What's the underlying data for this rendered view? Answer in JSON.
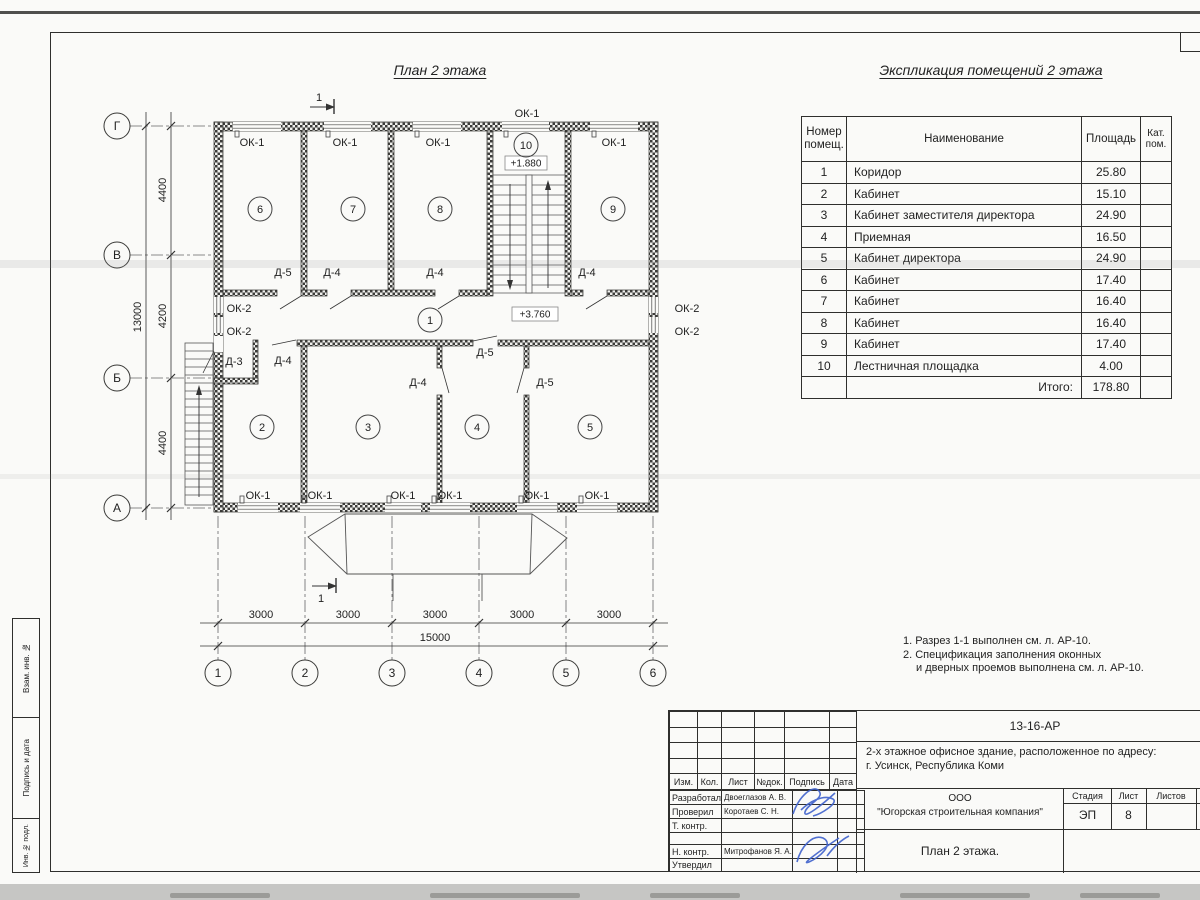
{
  "sheet": {
    "plan_title": "План 2 этажа",
    "expl_title": "Экспликация помещений 2 этажа",
    "notes": [
      "1. Разрез 1-1 выполнен см. л. АР-10.",
      "2. Спецификация заполнения оконных",
      "и дверных проемов выполнена см. л. АР-10."
    ]
  },
  "plan": {
    "axes_v": [
      "Г",
      "В",
      "Б",
      "А"
    ],
    "axes_h": [
      "1",
      "2",
      "3",
      "4",
      "5",
      "6"
    ],
    "dim_v": [
      "4400",
      "4200",
      "4400"
    ],
    "dim_v_total": "13000",
    "dim_h": [
      "3000",
      "3000",
      "3000",
      "3000",
      "3000"
    ],
    "dim_h_total": "15000",
    "rooms": [
      "1",
      "2",
      "3",
      "4",
      "5",
      "6",
      "7",
      "8",
      "9",
      "10"
    ],
    "level_stair": "+1.880",
    "level_corridor": "+3.760",
    "ok1": "ОК-1",
    "ok2": "ОК-2",
    "d3": "Д-3",
    "d4": "Д-4",
    "d5": "Д-5",
    "section": "1"
  },
  "expl": {
    "header": {
      "num1": "Номер",
      "num2": "помещ.",
      "name": "Наименование",
      "area": "Площадь",
      "cat1": "Кат.",
      "cat2": "пом."
    },
    "rows": [
      {
        "n": "1",
        "name": "Коридор",
        "area": "25.80"
      },
      {
        "n": "2",
        "name": "Кабинет",
        "area": "15.10"
      },
      {
        "n": "3",
        "name": "Кабинет заместителя директора",
        "area": "24.90"
      },
      {
        "n": "4",
        "name": "Приемная",
        "area": "16.50"
      },
      {
        "n": "5",
        "name": "Кабинет директора",
        "area": "24.90"
      },
      {
        "n": "6",
        "name": "Кабинет",
        "area": "17.40"
      },
      {
        "n": "7",
        "name": "Кабинет",
        "area": "16.40"
      },
      {
        "n": "8",
        "name": "Кабинет",
        "area": "16.40"
      },
      {
        "n": "9",
        "name": "Кабинет",
        "area": "17.40"
      },
      {
        "n": "10",
        "name": "Лестничная площадка",
        "area": "4.00"
      }
    ],
    "total_label": "Итого:",
    "total": "178.80"
  },
  "stamp": {
    "doc": "13-16-АР",
    "desc1": "2-х этажное офисное здание, расположенное по адресу:",
    "desc2": "г. Усинск, Республика Коми",
    "org1": "ООО",
    "org2": "\"Югорская строительная компания\"",
    "title": "План 2 этажа.",
    "stage_h": "Стадия",
    "sheet_h": "Лист",
    "sheets_h": "Листов",
    "stage": "ЭП",
    "sheet": "8",
    "cols": [
      "Изм.",
      "Кол.",
      "Лист",
      "№док.",
      "Подпись",
      "Дата"
    ],
    "rows": [
      {
        "role": "Разработал",
        "person": "Двоеглазов А. В."
      },
      {
        "role": "Проверил",
        "person": "Коротаев С. Н."
      },
      {
        "role": "Т. контр.",
        "person": ""
      },
      {
        "role": "",
        "person": ""
      },
      {
        "role": "Н. контр.",
        "person": "Митрофанов Я. А."
      },
      {
        "role": "Утвердил",
        "person": ""
      }
    ]
  },
  "strip": {
    "a": "Взам. инв. №",
    "b": "Подпись и дата",
    "c": "Инв. № подл."
  }
}
